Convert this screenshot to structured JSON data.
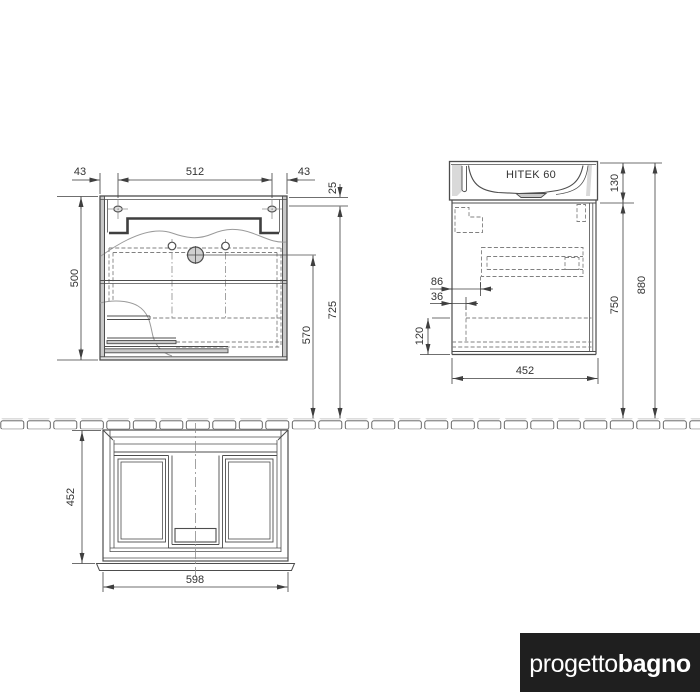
{
  "drawing": {
    "front_view": {
      "dim_left_gap": "43",
      "dim_holes_span": "512",
      "dim_right_gap": "43",
      "dim_top_offset": "25",
      "dim_height": "500",
      "dim_mount_height": "725",
      "dim_faucet_height": "570"
    },
    "side_view": {
      "model_label": "HITEK 60",
      "dim_basin_height": "130",
      "dim_total_height": "880",
      "dim_cabinet_height": "750",
      "dim_back_offset_a": "86",
      "dim_back_offset_b": "36",
      "dim_bottom_clear": "120",
      "dim_depth": "452"
    },
    "plan_view": {
      "dim_depth": "452",
      "dim_width": "598"
    },
    "logo": {
      "part1": "progetto",
      "part2": "bagno"
    },
    "colors": {
      "line": "#4d4d4d",
      "panel_fill": "#c9c9c9",
      "logo_bg": "#1f1f1f"
    }
  }
}
